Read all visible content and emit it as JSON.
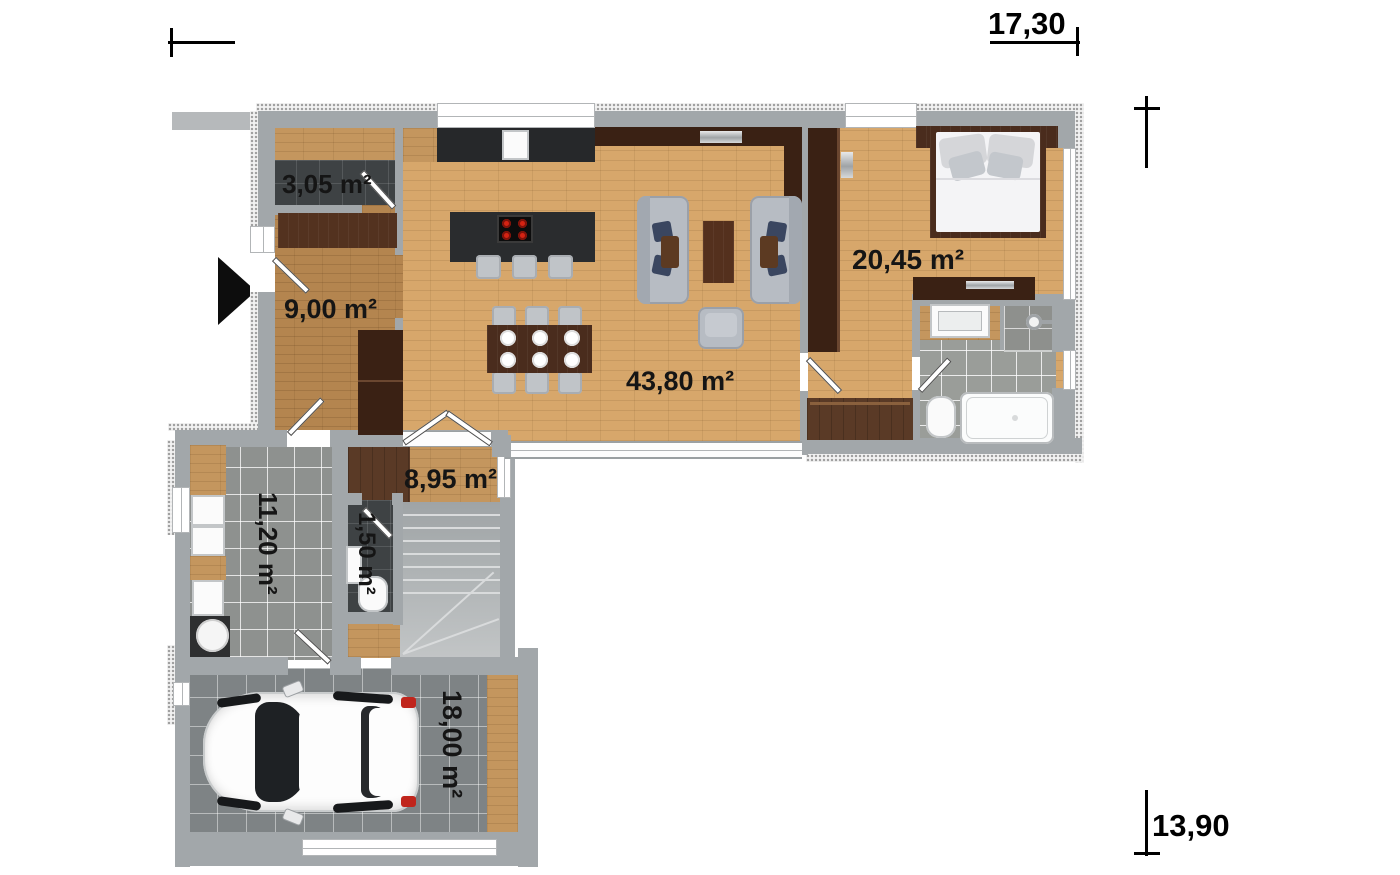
{
  "title": "single-storey house floor plan",
  "dimensions": {
    "width_label": "17,30",
    "height_label": "13,90"
  },
  "rooms": [
    {
      "id": "storage",
      "area_label": "3,05 m²"
    },
    {
      "id": "hallway",
      "area_label": "9,00 m²"
    },
    {
      "id": "living",
      "area_label": "43,80 m²"
    },
    {
      "id": "bedroom",
      "area_label": "20,45 m²"
    },
    {
      "id": "office",
      "area_label": "8,95 m²"
    },
    {
      "id": "utility",
      "area_label": "11,20 m²"
    },
    {
      "id": "wc",
      "area_label": "1,50 m²"
    },
    {
      "id": "garage",
      "area_label": "18,00 m²"
    }
  ],
  "icons": {
    "entrance": "entrance-arrow"
  },
  "colors": {
    "wall": "#a2a7aa",
    "wood_light": "#d7a76b",
    "wood_hall": "#b4854f",
    "walnut_furniture": "#4a2c1d",
    "tile_gray": "#8e918f",
    "tile_dark": "#3e4244",
    "burner_red": "#d42313",
    "label_text": "#151515"
  }
}
